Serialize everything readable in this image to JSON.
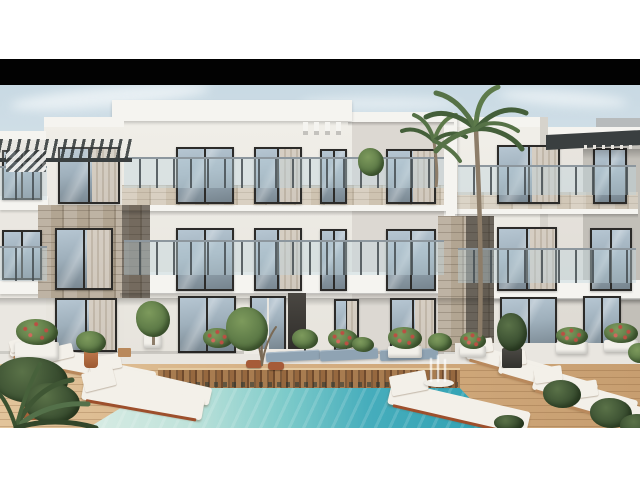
{
  "scene": {
    "subject": "3D architectural rendering of a modern white three-storey apartment complex with natural stone accents, glass balcony railings, palm trees, planters with red flowers, white sun loungers, a wooden pool deck and a turquoise swimming pool",
    "setting": "daytime exterior, pale blue sky with thin clouds, letterboxed image with black bar above and white page margins",
    "counts": {
      "floors": 3,
      "palm_trees": 2,
      "pool": 1,
      "white_loungers": 9,
      "gray_loungers": 3
    }
  },
  "palette": {
    "page_bg": "#ffffff",
    "letterbox": "#020202",
    "sky_top": "#c8d9e3",
    "sky_mid": "#dce7ed",
    "sky_bottom": "#eef2f3",
    "cloud_white": "#f8fbfc",
    "bg_building_gray": "#b7bbbc",
    "wall_light": "#f0eee8",
    "wall_mid": "#e6e3dc",
    "wall_shade": "#d6d3cc",
    "wall_recess": "#dcd8d2",
    "fascia_white": "#f5f4f0",
    "frame_dark": "#2c2b29",
    "glass_top": "#b6c6d2",
    "glass_bottom": "#76848e",
    "curtain": "#d8cec1",
    "stone_base": "#b2a592",
    "stone_light": "#cec3b1",
    "rail_glass": "rgba(190,212,222,0.42)",
    "rail_post": "rgba(70,78,82,0.85)",
    "pergola_dark": "#3a3f40",
    "terrace_pale": "#e9e6e0",
    "deck_light": "#e2c49b",
    "deck_mid": "#d2ab7e",
    "deck_dark": "#c79e70",
    "slat_a": "#a87c50",
    "slat_b": "#7e5a3a",
    "slat_c": "#96683f",
    "slat_d": "#6f4a2d",
    "pool_pale": "#d9ece4",
    "pool_mid": "#7ecbca",
    "pool_teal": "#46adbc",
    "pool_deep": "#2da0b2",
    "lounger_white": "#f3f0e9",
    "lounger_gray": "#8fa3b3",
    "lounger_wood": "#b9895c",
    "lounger_wood_red": "#9d4f2c",
    "plant_green": "#5d7a47",
    "plant_green_light": "#7d9a5c",
    "plant_dark": "#3d5233",
    "flower_red": "#bb4f43",
    "terracotta": "#c07a4d",
    "pot_white": "#f2f0ea",
    "pot_dark": "#32312d",
    "palm_light": "#5d7a4a",
    "palm_mid": "#567247",
    "palm_dark": "#445f3a",
    "trunk_brown": "#8d7d69"
  }
}
